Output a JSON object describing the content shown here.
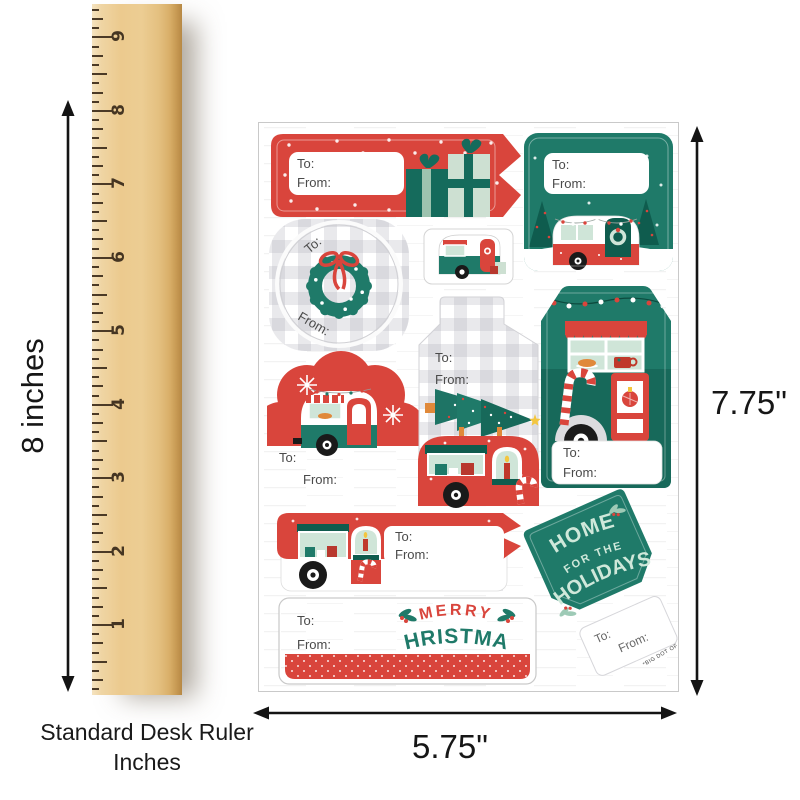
{
  "labels": {
    "to": "To:",
    "from": "From:"
  },
  "ruler": {
    "numbers": [
      "1",
      "2",
      "3",
      "4",
      "5",
      "6",
      "7",
      "8",
      "9"
    ],
    "caption_line1": "Standard Desk Ruler",
    "caption_line2": "Inches"
  },
  "measurements": {
    "ruler_height": "8 inches",
    "sheet_height": "7.75\"",
    "sheet_width": "5.75\""
  },
  "sheet": {
    "merry_line1": "MERRY",
    "merry_line2": "CHRISTMAS",
    "holidays_line1": "HOME",
    "holidays_line2": "FOR THE",
    "holidays_line3": "HOLIDAYS",
    "brand": "*BIG DOT OF HAPPINESS*"
  },
  "colors": {
    "red": "#d9453c",
    "teal": "#1f7a69",
    "dark_teal": "#0f5c4e",
    "mint": "#cfe5d8",
    "plaid_gray": "#aeaeb8",
    "wood": "#ecca8e"
  }
}
